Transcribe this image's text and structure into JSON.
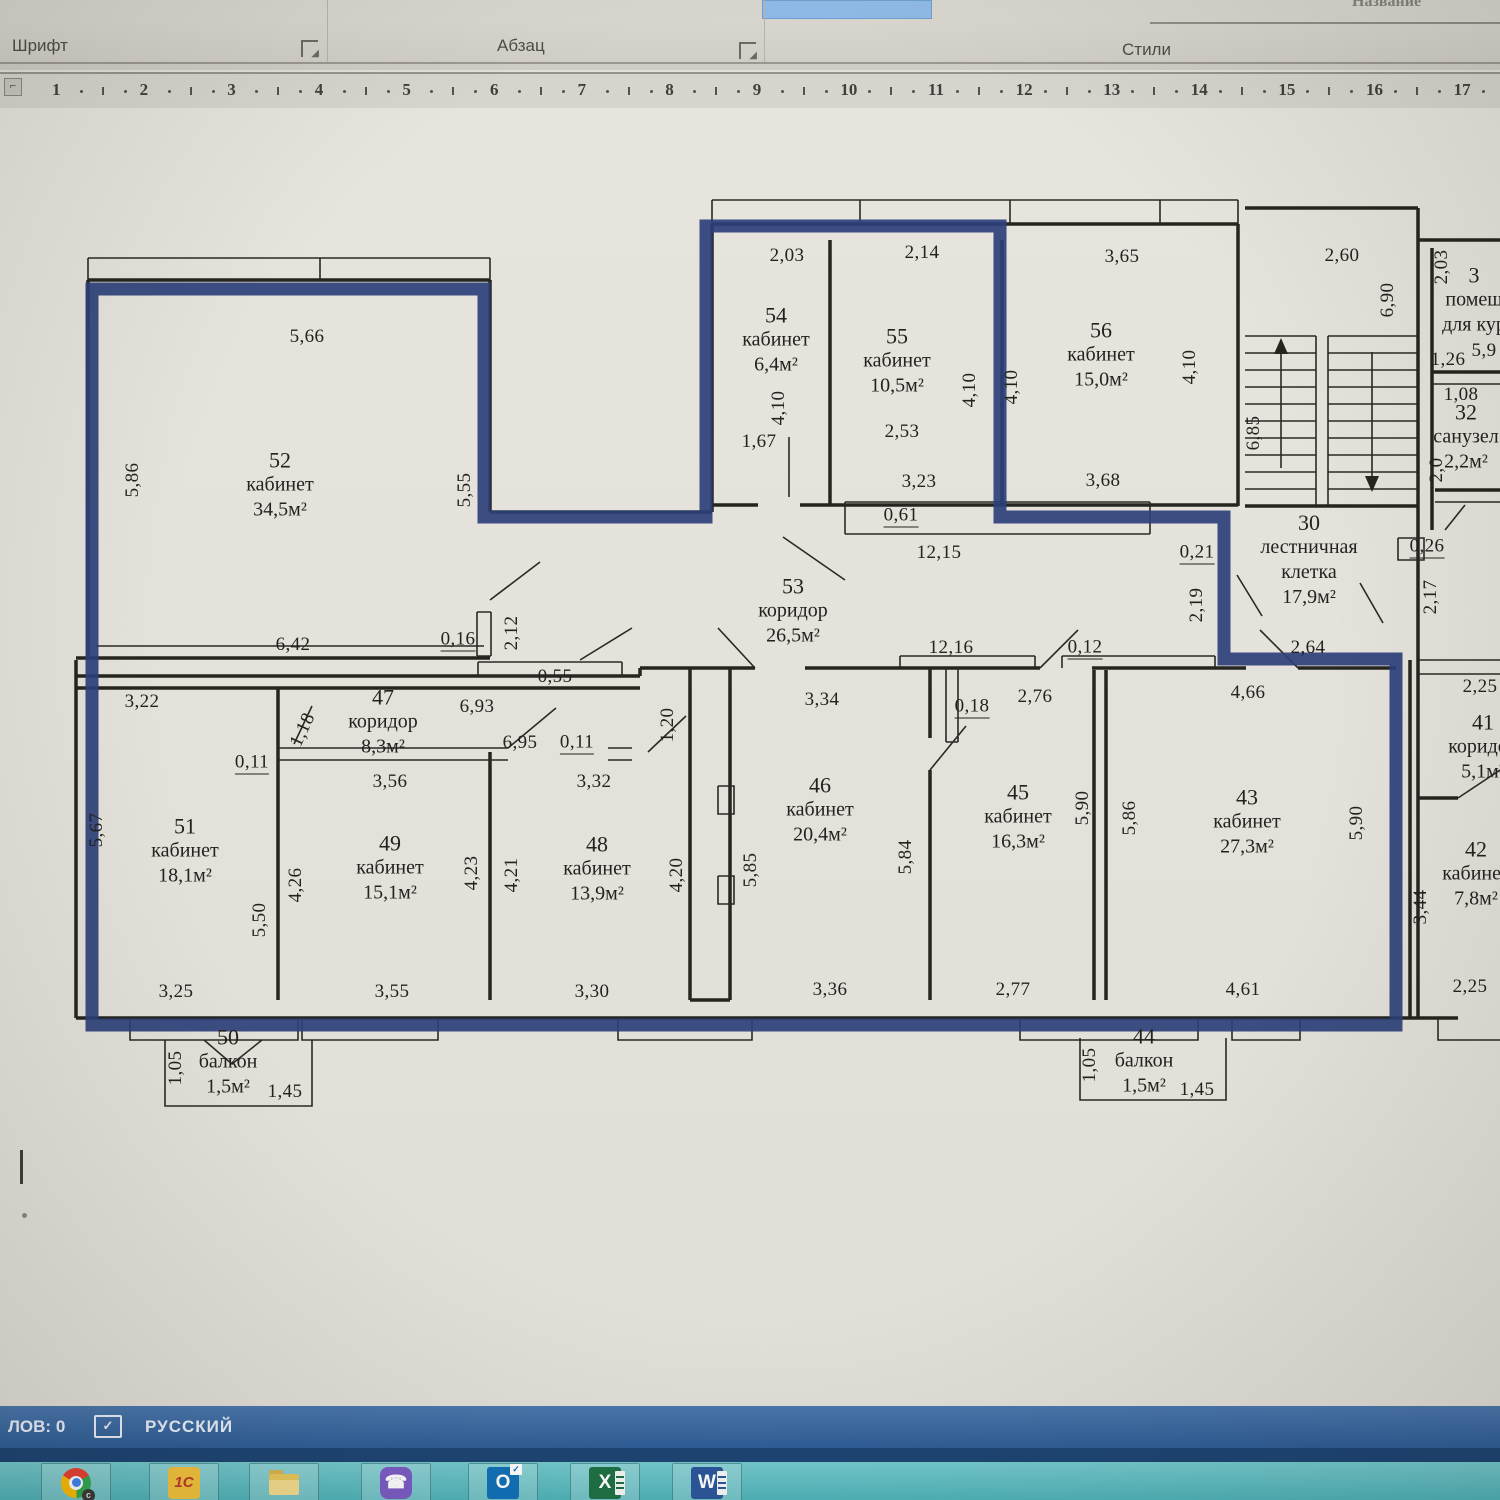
{
  "ribbon": {
    "group_font": "Шрифт",
    "group_paragraph": "Абзац",
    "group_styles": "Стили",
    "style_gallery_item": "Название"
  },
  "ruler": {
    "marks": [
      "1",
      "2",
      "3",
      "4",
      "5",
      "6",
      "7",
      "8",
      "9",
      "10",
      "11",
      "12",
      "13",
      "14",
      "15",
      "16",
      "17"
    ]
  },
  "plan": {
    "selection_color": "#2d4079",
    "rooms": {
      "r52": {
        "num": "52",
        "type": "кабинет",
        "area": "34,5м²"
      },
      "r54": {
        "num": "54",
        "type": "кабинет",
        "area": "6,4м²"
      },
      "r55": {
        "num": "55",
        "type": "кабинет",
        "area": "10,5м²"
      },
      "r56": {
        "num": "56",
        "type": "кабинет",
        "area": "15,0м²"
      },
      "r53": {
        "num": "53",
        "type": "коридор",
        "area": "26,5м²"
      },
      "r30": {
        "num": "30",
        "type": "лестничная клетка",
        "area": "17,9м²"
      },
      "r31": {
        "num": "3",
        "type": "помещ",
        "area": "для кур"
      },
      "r32": {
        "num": "32",
        "type": "санузел",
        "area": "2,2м²"
      },
      "r47": {
        "num": "47",
        "type": "коридор",
        "area": "8,3м²"
      },
      "r51": {
        "num": "51",
        "type": "кабинет",
        "area": "18,1м²"
      },
      "r49": {
        "num": "49",
        "type": "кабинет",
        "area": "15,1м²"
      },
      "r48": {
        "num": "48",
        "type": "кабинет",
        "area": "13,9м²"
      },
      "r46": {
        "num": "46",
        "type": "кабинет",
        "area": "20,4м²"
      },
      "r45": {
        "num": "45",
        "type": "кабинет",
        "area": "16,3м²"
      },
      "r43": {
        "num": "43",
        "type": "кабинет",
        "area": "27,3м²"
      },
      "r41": {
        "num": "41",
        "type": "коридор",
        "area": "5,1м²"
      },
      "r42": {
        "num": "42",
        "type": "кабинет",
        "area": "7,8м²"
      },
      "r50": {
        "num": "50",
        "type": "балкон",
        "area": "1,5м²"
      },
      "r44": {
        "num": "44",
        "type": "балкон",
        "area": "1,5м²"
      }
    },
    "dims": {
      "d5_66": "5,66",
      "d5_86": "5,86",
      "d5_55": "5,55",
      "d6_42": "6,42",
      "d0_16": "0,16",
      "d2_12": "2,12",
      "d2_03": "2,03",
      "d2_14": "2,14",
      "d3_65": "3,65",
      "d2_60": "2,60",
      "d6_90": "6,90",
      "d1_67": "1,67",
      "d4_10": "4,10",
      "d2_53": "2,53",
      "d3_23": "3,23",
      "d0_61": "0,61",
      "d12_15": "12,15",
      "d3_68": "3,68",
      "d6_85": "6,85",
      "d1_26": "1,26",
      "d5_9": "5,9",
      "d1_08": "1,08",
      "d2_0": "2,0",
      "d0_26": "0,26",
      "d2_17": "2,17",
      "d0_21": "0,21",
      "d2_19": "2,19",
      "d2_64": "2,64",
      "d4_66": "4,66",
      "d2_25": "2,25",
      "d12_16": "12,16",
      "d0_12": "0,12",
      "d3_34": "3,34",
      "d0_18": "0,18",
      "d2_76": "2,76",
      "d0_55": "0,55",
      "d6_93": "6,93",
      "d6_95": "6,95",
      "d0_11": "0,11",
      "d1_18": "1,18",
      "d3_56": "3,56",
      "d1_20": "1,20",
      "d3_22": "3,22",
      "d5_67": "5,67",
      "d5_50": "5,50",
      "d4_26": "4,26",
      "d3_25": "3,25",
      "d3_55": "3,55",
      "d4_23": "4,23",
      "d4_21": "4,21",
      "d4_20": "4,20",
      "d3_30": "3,30",
      "d3_32": "3,32",
      "d5_85": "5,85",
      "d5_84": "5,84",
      "d3_36": "3,36",
      "d2_77": "2,77",
      "d5_90": "5,90",
      "d4_61": "4,61",
      "d3_44": "3,44",
      "d1_05": "1,05",
      "d1_45": "1,45"
    }
  },
  "status_bar": {
    "word_count": "ЛОВ: 0",
    "proof_check": "✓",
    "language": "РУССКИЙ"
  },
  "taskbar": {
    "one_c_label": "1С",
    "viber_glyph": "☎",
    "outlook_letter": "O",
    "outlook_check": "✓",
    "excel_letter": "X",
    "word_letter": "W",
    "chrome_badge": "c"
  }
}
